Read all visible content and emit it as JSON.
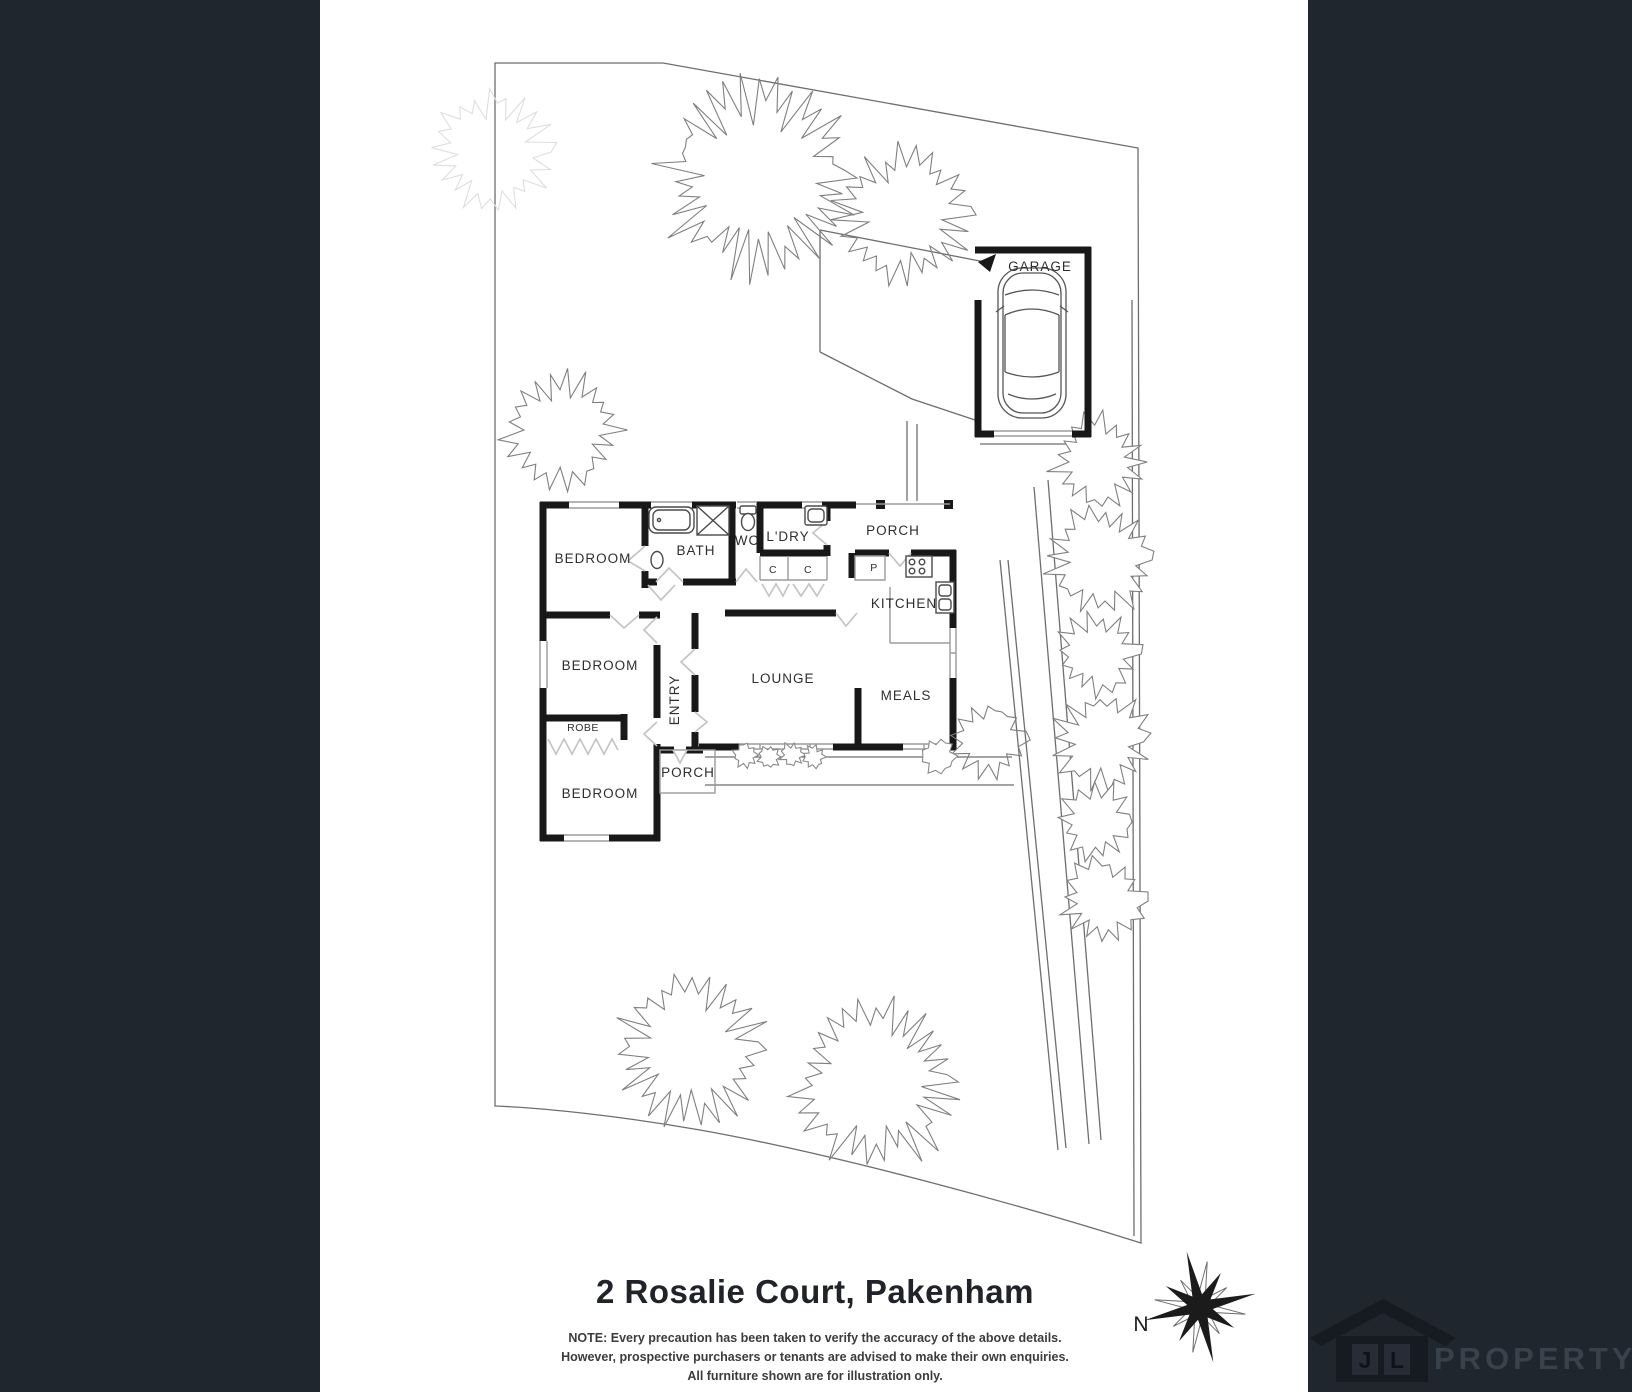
{
  "title": "2 Rosalie Court, Pakenham",
  "rooms": {
    "garage": "GARAGE",
    "porch_top": "PORCH",
    "bedroom_1": "BEDROOM",
    "bath": "BATH",
    "wc": "WC",
    "laundry": "L'DRY",
    "kitchen": "KITCHEN",
    "bedroom_2": "BEDROOM",
    "entry": "ENTRY",
    "lounge": "LOUNGE",
    "meals": "MEALS",
    "robe": "ROBE",
    "bedroom_3": "BEDROOM",
    "porch_bottom": "PORCH",
    "closet_1": "C",
    "closet_2": "C",
    "pantry": "P"
  },
  "disclaimer": {
    "line_1": "NOTE: Every precaution has been taken to verify the accuracy of the above details.",
    "line_2": "However, prospective purchasers or tenants are advised to make their own enquiries.",
    "line_3": "All furniture shown are for illustration only."
  },
  "compass": {
    "north": "N"
  },
  "logo": {
    "letter_1": "J",
    "letter_2": "L",
    "name": "PROPERTY"
  },
  "colors": {
    "background": "#20262e",
    "paper": "#ffffff",
    "wall": "#181818",
    "site_line": "#6e6e6e",
    "window_line": "#9b9b9b",
    "door_line": "#c4c4c4",
    "tree_line": "#7f7f7f",
    "faint_tree_line": "#dedede",
    "label_text": "#2f2f2f",
    "title_text": "#20242a",
    "note_text": "#3c3c3c",
    "compass": "#1b1b1b",
    "logo_house": "#161b22",
    "logo_panel": "#262d37",
    "logo_letter": "#0f1318",
    "logo_text": "#39414c"
  }
}
